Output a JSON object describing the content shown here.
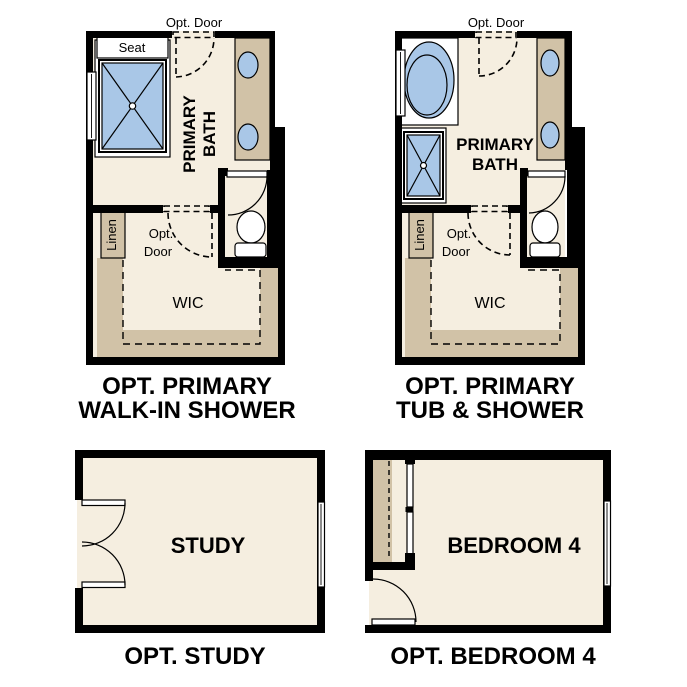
{
  "colors": {
    "background": "#ffffff",
    "floor": "#f5eee0",
    "cabinet_tan": "#d1c2a7",
    "fixture_blue": "#a9c7e7",
    "wall": "#000000",
    "text": "#000000"
  },
  "plans": {
    "walk_in_shower": {
      "caption": [
        "OPT. PRIMARY",
        "WALK-IN SHOWER"
      ],
      "labels": {
        "opt_door_top": "Opt. Door",
        "seat": "Seat",
        "room1": "PRIMARY",
        "room2": "BATH",
        "linen": "Linen",
        "opt": "Opt.",
        "door": "Door",
        "wic": "WIC"
      }
    },
    "tub_shower": {
      "caption": [
        "OPT. PRIMARY",
        "TUB & SHOWER"
      ],
      "labels": {
        "opt_door_top": "Opt. Door",
        "room1": "PRIMARY",
        "room2": "BATH",
        "linen": "Linen",
        "opt": "Opt.",
        "door": "Door",
        "wic": "WIC"
      }
    },
    "study": {
      "caption": [
        "OPT. STUDY"
      ],
      "labels": {
        "room": "STUDY"
      }
    },
    "bedroom4": {
      "caption": [
        "OPT. BEDROOM 4"
      ],
      "labels": {
        "room": "BEDROOM 4"
      }
    }
  }
}
